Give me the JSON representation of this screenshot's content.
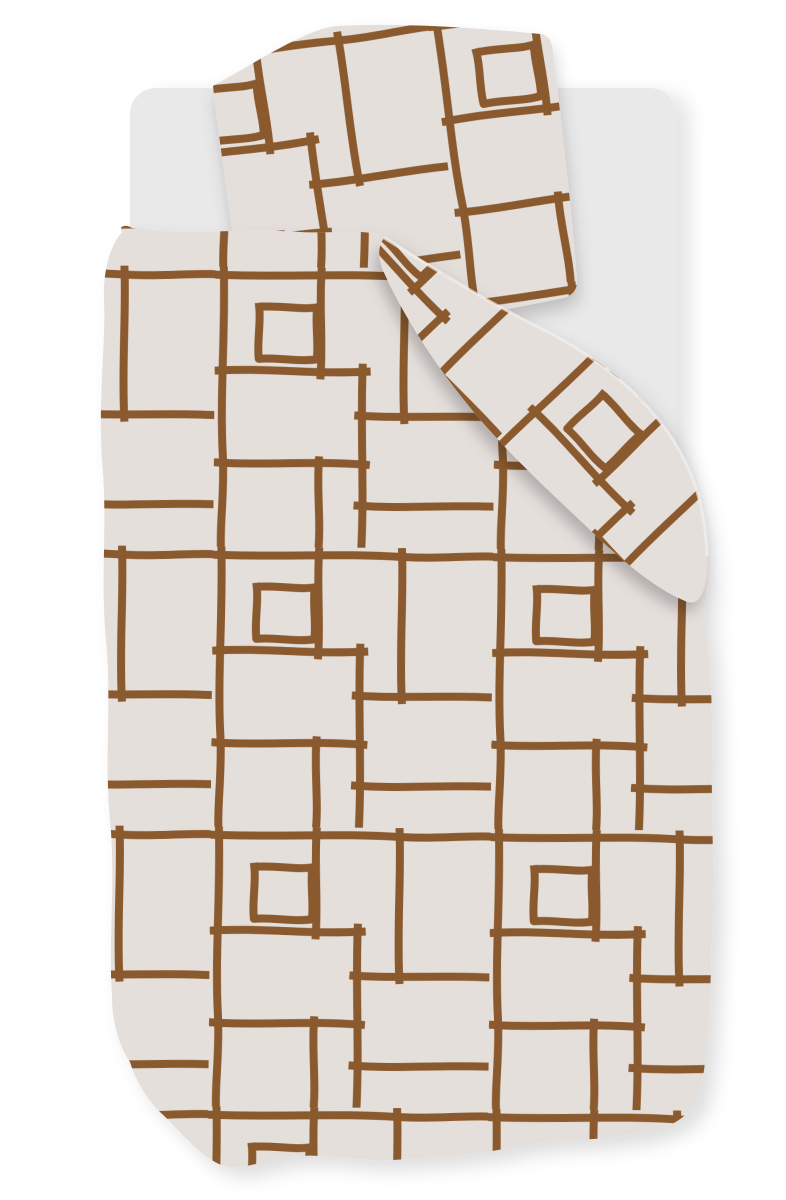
{
  "scene": {
    "kind": "product-photo",
    "subject": "bedding set with hand-drawn brown grid pattern on light linen",
    "objects": {
      "background": "white studio backdrop",
      "mattress": "light grey rounded mattress",
      "pillow": "patterned pillowcase, tilted",
      "duvet": "patterned duvet cover with wavy edges",
      "flap": "folded-over duvet corner draped diagonally"
    }
  },
  "colors": {
    "background": "#ffffff",
    "mattress": "#e9e9ea",
    "fabric": "#e5dfdc",
    "line": "#8a5a2d",
    "flap_edge": "#f4f0ed"
  }
}
